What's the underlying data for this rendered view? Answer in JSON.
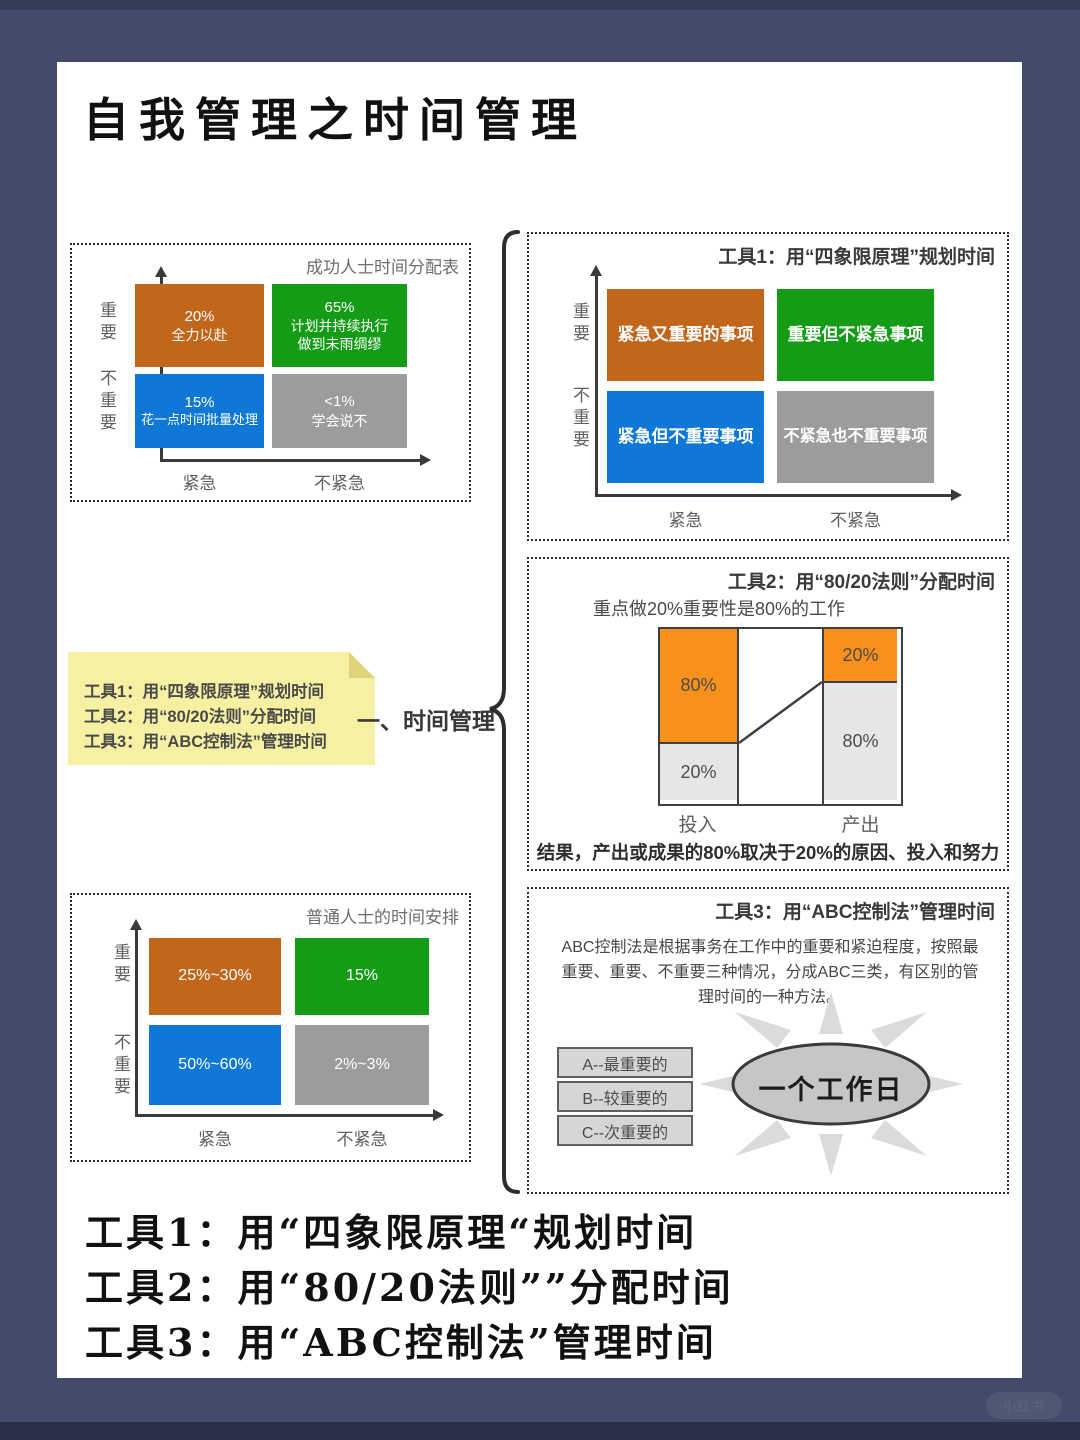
{
  "page": {
    "title": "自我管理之时间管理",
    "watermark": "小红书",
    "center_label": "一、时间管理"
  },
  "colors": {
    "frame": "#424b69",
    "quad_orange": "#c2661c",
    "quad_green": "#149c16",
    "quad_blue": "#0f78d7",
    "quad_gray": "#9c9c9c",
    "tool2_orange": "#f8911b",
    "tool2_gray": "#e6e6e6",
    "note_yellow": "#f6f1a2"
  },
  "chart_success": {
    "title": "成功人士时间分配表",
    "y_labels": [
      "重要",
      "不重要"
    ],
    "x_labels": [
      "紧急",
      "不紧急"
    ],
    "quadrants": [
      {
        "lines": [
          "20%",
          "全力以赴"
        ]
      },
      {
        "lines": [
          "65%",
          "计划并持续执行",
          "做到未雨绸缪"
        ]
      },
      {
        "lines": [
          "15%",
          "花一点时间批量处理"
        ]
      },
      {
        "lines": [
          "<1%",
          "学会说不"
        ]
      }
    ]
  },
  "tool1": {
    "title": "工具1：用“四象限原理”规划时间",
    "y_labels": [
      "重要",
      "不重要"
    ],
    "x_labels": [
      "紧急",
      "不紧急"
    ],
    "quadrants": [
      {
        "label": "紧急又重要的事项"
      },
      {
        "label": "重要但不紧急事项"
      },
      {
        "label": "紧急但不重要事项"
      },
      {
        "label": "不紧急也不重要事项"
      }
    ]
  },
  "tool2": {
    "title": "工具2：用“80/20法则”分配时间",
    "subtitle": "重点做20%重要性是80%的工作",
    "input_label": "投入",
    "output_label": "产出",
    "input_top": "80%",
    "input_bottom": "20%",
    "output_top": "20%",
    "output_bottom": "80%",
    "conclusion": "结果，产出或成果的80%取决于20%的原因、投入和努力"
  },
  "tool3": {
    "title": "工具3：用“ABC控制法”管理时间",
    "description": "ABC控制法是根据事务在工作中的重要和紧迫程度，按照最重要、重要、不重要三种情况，分成ABC三类，有区别的管理时间的一种方法。",
    "categories": [
      "A--最重要的",
      "B--较重要的",
      "C--次重要的"
    ],
    "sun_label": "一个工作日"
  },
  "chart_ordinary": {
    "title": "普通人士的时间安排",
    "y_labels": [
      "重要",
      "不重要"
    ],
    "x_labels": [
      "紧急",
      "不紧急"
    ],
    "quadrants": [
      {
        "label": "25%~30%"
      },
      {
        "label": "15%"
      },
      {
        "label": "50%~60%"
      },
      {
        "label": "2%~3%"
      }
    ]
  },
  "note": {
    "lines": [
      "工具1：用“四象限原理”规划时间",
      "工具2：用“80/20法则”分配时间",
      "工具3：用“ABC控制法”管理时间"
    ]
  },
  "footer": {
    "lines": [
      "工具1：用“四象限原理“规划时间",
      "工具2：用“80/20法则””分配时间",
      "工具3：用“ABC控制法”管理时间"
    ]
  }
}
